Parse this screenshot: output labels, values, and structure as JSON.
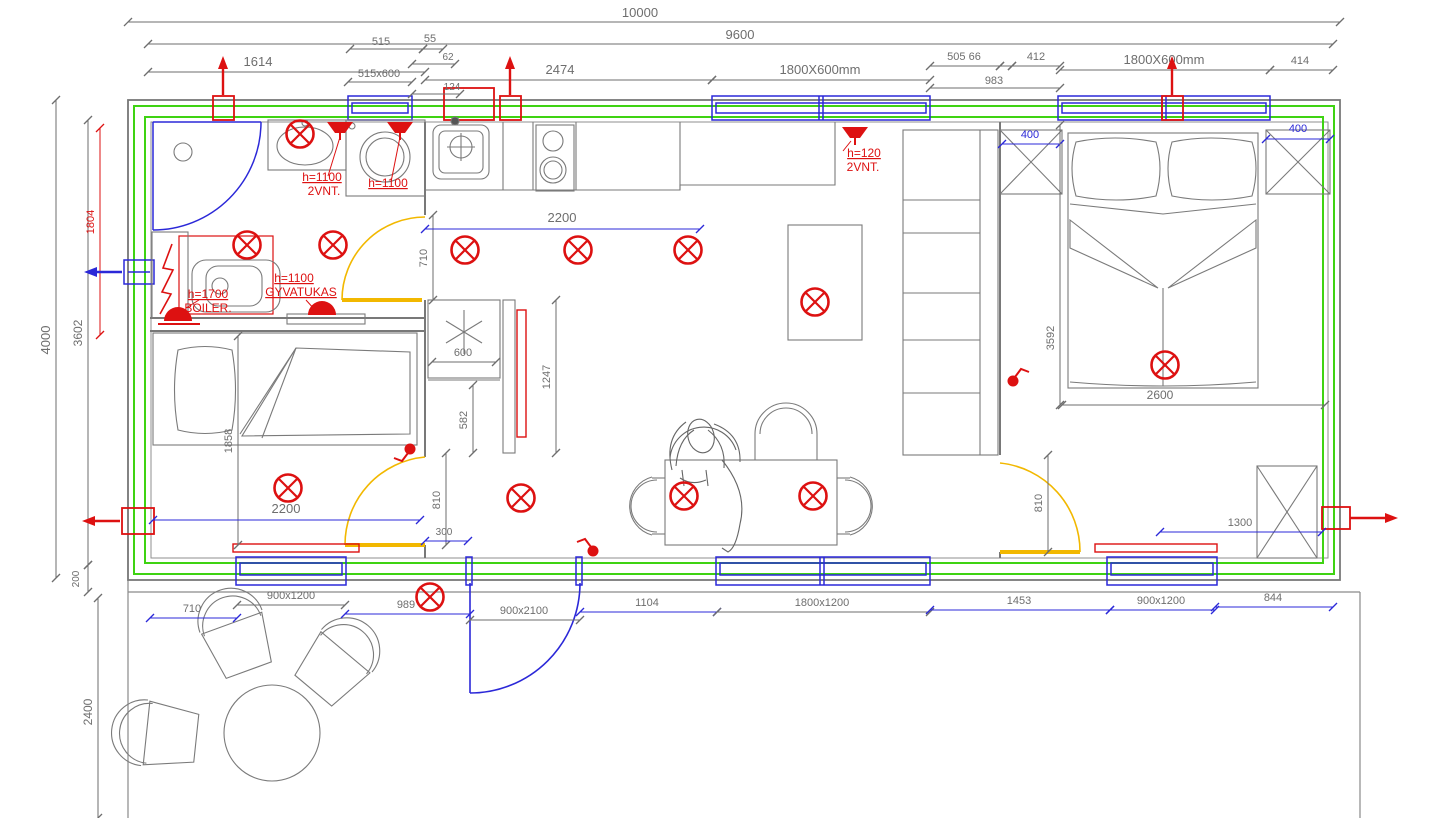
{
  "drawing": {
    "kind": "house floor plan with electrical installation layout",
    "colors": {
      "wall": "#787878",
      "insulation": "#3fd312",
      "window": "#2b28d8",
      "electric": "#dd1111",
      "door": "#f2b800",
      "dim_gray": "#6e6e6e",
      "dim_blue": "#2b28d8",
      "furniture": "#7a7a7a"
    }
  },
  "dimensions": {
    "labels": [
      [
        "10000",
        640,
        17,
        0,
        "g",
        13,
        0
      ],
      [
        "9600",
        740,
        39,
        0,
        "g",
        13,
        0
      ],
      [
        "1614",
        258,
        66,
        0,
        "g",
        13,
        0
      ],
      [
        "515",
        381,
        45,
        0,
        "g",
        11,
        0
      ],
      [
        "55",
        430,
        42,
        0,
        "g",
        11,
        0
      ],
      [
        "62",
        448,
        60,
        0,
        "g",
        10,
        0
      ],
      [
        "515x600",
        379,
        77,
        0,
        "g",
        11,
        0
      ],
      [
        "124",
        452,
        90,
        0,
        "g",
        10,
        0
      ],
      [
        "2474",
        560,
        74,
        0,
        "g",
        13,
        0
      ],
      [
        "1800X600mm",
        820,
        74,
        0,
        "g",
        13,
        0
      ],
      [
        "505 66",
        964,
        60,
        0,
        "g",
        11,
        0
      ],
      [
        "412",
        1036,
        60,
        0,
        "g",
        11,
        0
      ],
      [
        "983",
        994,
        84,
        0,
        "g",
        11,
        0
      ],
      [
        "1800X600mm",
        1164,
        64,
        0,
        "g",
        13,
        0
      ],
      [
        "414",
        1300,
        64,
        0,
        "g",
        11,
        0
      ],
      [
        "4000",
        50,
        340,
        -90,
        "g",
        13,
        0
      ],
      [
        "3602",
        82,
        333,
        -90,
        "g",
        12,
        0
      ],
      [
        "200",
        79,
        579,
        -90,
        "g",
        10,
        0
      ],
      [
        "2400",
        92,
        712,
        -90,
        "g",
        12,
        0
      ],
      [
        "1804",
        94,
        222,
        -90,
        "r",
        11,
        0
      ],
      [
        "710",
        427,
        258,
        -90,
        "g",
        11,
        0
      ],
      [
        "2200",
        562,
        222,
        0,
        "g",
        13,
        0
      ],
      [
        "600",
        463,
        356,
        0,
        "g",
        11,
        0
      ],
      [
        "1247",
        550,
        377,
        -90,
        "g",
        11,
        0
      ],
      [
        "582",
        467,
        420,
        -90,
        "g",
        11,
        0
      ],
      [
        "810",
        440,
        500,
        -90,
        "g",
        11,
        0
      ],
      [
        "300",
        444,
        535,
        0,
        "g",
        10,
        0
      ],
      [
        "1858",
        232,
        441,
        -90,
        "g",
        11,
        0
      ],
      [
        "2200",
        286,
        513,
        0,
        "g",
        13,
        0
      ],
      [
        "900x1200",
        291,
        599,
        0,
        "g",
        11,
        0
      ],
      [
        "710",
        192,
        612,
        0,
        "g",
        11,
        0
      ],
      [
        "989",
        406,
        608,
        0,
        "g",
        11,
        0
      ],
      [
        "900x2100",
        524,
        614,
        0,
        "g",
        11,
        0
      ],
      [
        "1104",
        647,
        606,
        0,
        "g",
        11,
        0
      ],
      [
        "1800x1200",
        822,
        606,
        0,
        "g",
        11,
        0
      ],
      [
        "1453",
        1019,
        604,
        0,
        "g",
        11,
        0
      ],
      [
        "900x1200",
        1161,
        604,
        0,
        "g",
        11,
        0
      ],
      [
        "844",
        1273,
        601,
        0,
        "g",
        11,
        0
      ],
      [
        "400",
        1030,
        138,
        0,
        "b",
        11,
        0
      ],
      [
        "400",
        1298,
        132,
        0,
        "b",
        11,
        0
      ],
      [
        "3592",
        1054,
        338,
        -90,
        "g",
        11,
        0
      ],
      [
        "2600",
        1160,
        399,
        0,
        "g",
        12,
        0
      ],
      [
        "1300",
        1240,
        526,
        0,
        "g",
        11,
        0
      ],
      [
        "810",
        1042,
        503,
        -90,
        "g",
        11,
        0
      ],
      [
        "h=1100",
        322,
        181,
        0,
        "r",
        12,
        1
      ],
      [
        "2VNT.",
        324,
        195,
        0,
        "r",
        12,
        0
      ],
      [
        "h=1100",
        388,
        187,
        0,
        "r",
        12,
        1
      ],
      [
        "h=120",
        864,
        157,
        0,
        "r",
        12,
        1
      ],
      [
        "2VNT.",
        863,
        171,
        0,
        "r",
        12,
        0
      ],
      [
        "h=1700",
        208,
        298,
        0,
        "r",
        12,
        1
      ],
      [
        "BOILER.",
        208,
        312,
        0,
        "r",
        12,
        0
      ],
      [
        "h=1100",
        294,
        282,
        0,
        "r",
        12,
        1
      ],
      [
        "GYVATUKAS",
        301,
        296,
        0,
        "r",
        12,
        1
      ]
    ],
    "lines": [
      [
        128,
        22,
        1340,
        22,
        "g"
      ],
      [
        148,
        44,
        1333,
        44,
        "g"
      ],
      [
        148,
        72,
        425,
        72,
        "g"
      ],
      [
        350,
        49,
        423,
        49,
        "g"
      ],
      [
        423,
        49,
        443,
        49,
        "g"
      ],
      [
        412,
        64,
        455,
        64,
        "g"
      ],
      [
        348,
        82,
        412,
        82,
        "g"
      ],
      [
        412,
        94,
        460,
        94,
        "g"
      ],
      [
        425,
        80,
        712,
        80,
        "g"
      ],
      [
        712,
        80,
        930,
        80,
        "g"
      ],
      [
        930,
        66,
        1000,
        66,
        "g"
      ],
      [
        1000,
        66,
        1012,
        66,
        "g"
      ],
      [
        1012,
        66,
        1060,
        66,
        "g"
      ],
      [
        930,
        88,
        1060,
        88,
        "g"
      ],
      [
        1060,
        70,
        1270,
        70,
        "g"
      ],
      [
        1270,
        70,
        1333,
        70,
        "g"
      ],
      [
        56,
        100,
        56,
        578,
        "g"
      ],
      [
        88,
        120,
        88,
        565,
        "g"
      ],
      [
        88,
        565,
        88,
        592,
        "g"
      ],
      [
        98,
        598,
        98,
        818,
        "g"
      ],
      [
        100,
        128,
        100,
        335,
        "r"
      ],
      [
        433,
        215,
        433,
        300,
        "g"
      ],
      [
        425,
        229,
        700,
        229,
        "b"
      ],
      [
        432,
        362,
        496,
        362,
        "g"
      ],
      [
        556,
        300,
        556,
        453,
        "g"
      ],
      [
        473,
        385,
        473,
        453,
        "g"
      ],
      [
        446,
        453,
        446,
        545,
        "g"
      ],
      [
        425,
        541,
        468,
        541,
        "b"
      ],
      [
        238,
        336,
        238,
        545,
        "g"
      ],
      [
        153,
        520,
        420,
        520,
        "b"
      ],
      [
        237,
        605,
        345,
        605,
        "g"
      ],
      [
        150,
        618,
        237,
        618,
        "b"
      ],
      [
        345,
        614,
        470,
        614,
        "b"
      ],
      [
        470,
        620,
        580,
        620,
        "g"
      ],
      [
        580,
        612,
        717,
        612,
        "b"
      ],
      [
        717,
        612,
        930,
        612,
        "g"
      ],
      [
        930,
        610,
        1110,
        610,
        "b"
      ],
      [
        1110,
        610,
        1215,
        610,
        "b"
      ],
      [
        1215,
        607,
        1333,
        607,
        "b"
      ],
      [
        1002,
        144,
        1060,
        144,
        "b"
      ],
      [
        1266,
        139,
        1330,
        139,
        "b"
      ],
      [
        1060,
        125,
        1060,
        405,
        "g"
      ],
      [
        1062,
        405,
        1325,
        405,
        "g"
      ],
      [
        1160,
        532,
        1322,
        532,
        "b"
      ],
      [
        1048,
        455,
        1048,
        552,
        "g"
      ]
    ]
  },
  "annotations": {
    "leaders": [
      [
        340,
        137,
        328,
        176
      ],
      [
        400,
        137,
        391,
        182
      ],
      [
        851,
        141,
        843,
        151
      ],
      [
        186,
        308,
        199,
        300
      ],
      [
        315,
        310,
        306,
        300
      ]
    ]
  },
  "symbols": {
    "ceiling_lights": [
      [
        300,
        134
      ],
      [
        247,
        245
      ],
      [
        333,
        245
      ],
      [
        465,
        250
      ],
      [
        578,
        250
      ],
      [
        688,
        250
      ],
      [
        815,
        302
      ],
      [
        1165,
        365
      ],
      [
        288,
        488
      ],
      [
        521,
        498
      ],
      [
        684,
        496
      ],
      [
        813,
        496
      ],
      [
        430,
        597
      ]
    ],
    "wall_lamps": [
      [
        340,
        129
      ],
      [
        400,
        129
      ],
      [
        855,
        134
      ]
    ],
    "dome_lamps": [
      [
        178,
        319
      ],
      [
        322,
        313
      ]
    ],
    "switches": [
      [
        410,
        449,
        -1,
        -1
      ],
      [
        593,
        551,
        -1,
        1
      ],
      [
        1013,
        381,
        1,
        1
      ]
    ],
    "arrows": [
      [
        223,
        95,
        223,
        56,
        "r"
      ],
      [
        510,
        95,
        510,
        56,
        "r"
      ],
      [
        1172,
        95,
        1172,
        56,
        "r"
      ],
      [
        122,
        272,
        84,
        272,
        "w"
      ],
      [
        120,
        521,
        82,
        521,
        "r"
      ],
      [
        1350,
        518,
        1398,
        518,
        "r"
      ]
    ]
  }
}
